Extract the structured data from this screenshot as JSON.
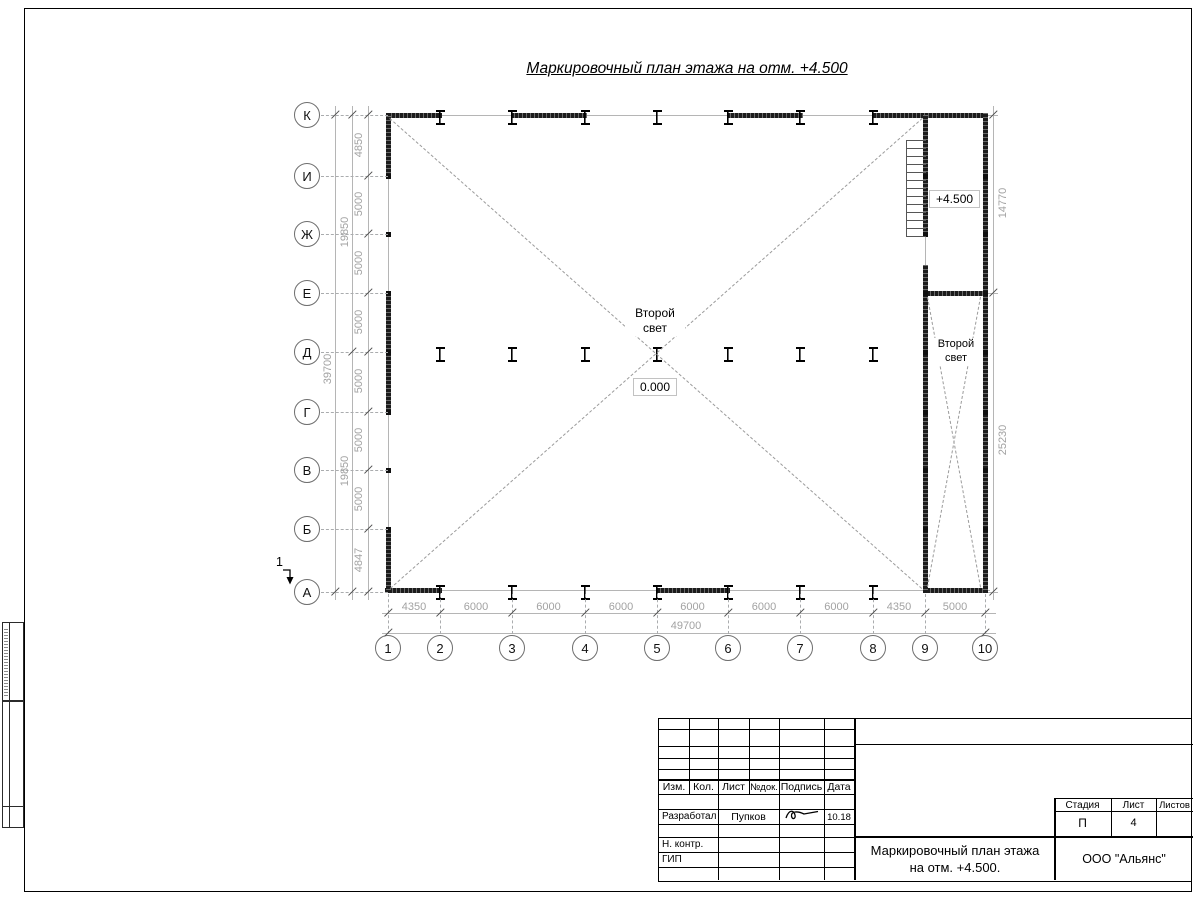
{
  "sheet": {
    "title": "Маркировочный план этажа на отм. +4.500"
  },
  "colors": {
    "wall": "#1c1c1c",
    "grayline": "#b5b5b5",
    "dimtext": "#a2a2a2",
    "dashline": "#9b9b9b"
  },
  "plan": {
    "axes": {
      "rows": [
        "К",
        "И",
        "Ж",
        "Е",
        "Д",
        "Г",
        "В",
        "Б",
        "А"
      ],
      "cols": [
        "1",
        "2",
        "3",
        "4",
        "5",
        "6",
        "7",
        "8",
        "9",
        "10"
      ]
    },
    "dimensions": {
      "left_inner": [
        "4850",
        "5000",
        "5000",
        "5000",
        "5000",
        "5000",
        "5000",
        "4847"
      ],
      "left_sub": [
        "19850",
        "19850"
      ],
      "left_total": "39700",
      "bottom_inner": [
        "4350",
        "6000",
        "6000",
        "6000",
        "6000",
        "6000",
        "6000",
        "4350",
        "5000"
      ],
      "bottom_total": "49700",
      "right": [
        "14770",
        "25230"
      ]
    },
    "labels": {
      "second_light_main": "Второй свет",
      "second_light_wing": "Второй свет",
      "elevation_main": "0.000",
      "elevation_wing": "+4.500",
      "section_mark": "1"
    }
  },
  "title_block": {
    "rev_cols": [
      "Изм.",
      "Кол.",
      "Лист",
      "№док.",
      "Подпись",
      "Дата"
    ],
    "roles": {
      "developed": "Разработал",
      "norm": "Н. контр.",
      "gip": "ГИП"
    },
    "developer_name": "Пупков",
    "developer_date": "10.18",
    "doc_title_line1": "Маркировочный план этажа",
    "doc_title_line2": "на отм. +4.500.",
    "stage_label": "Стадия",
    "sheet_label": "Лист",
    "sheets_label": "Листов",
    "stage_value": "П",
    "sheet_value": "4",
    "sheets_value": "",
    "company": "ООО \"Альянс\""
  }
}
